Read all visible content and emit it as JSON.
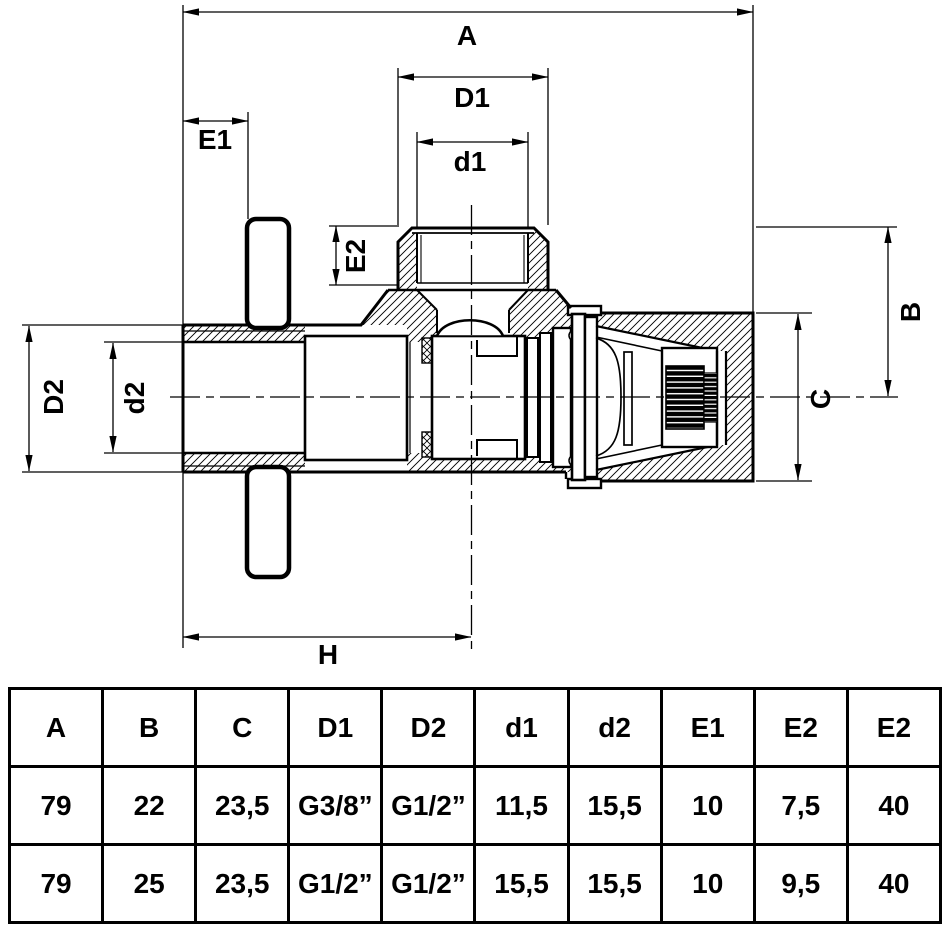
{
  "drawing": {
    "labels": {
      "a": "A",
      "d1_outer": "D1",
      "d1_inner": "d1",
      "e1": "E1",
      "e2": "E2",
      "b": "B",
      "c": "C",
      "d2_outer": "D2",
      "d2_inner": "d2",
      "h": "H"
    }
  },
  "table": {
    "headers": [
      "A",
      "B",
      "C",
      "D1",
      "D2",
      "d1",
      "d2",
      "E1",
      "E2",
      "E2"
    ],
    "rows": [
      [
        "79",
        "22",
        "23,5",
        "G3/8”",
        "G1/2”",
        "11,5",
        "15,5",
        "10",
        "7,5",
        "40"
      ],
      [
        "79",
        "25",
        "23,5",
        "G1/2”",
        "G1/2”",
        "15,5",
        "15,5",
        "10",
        "9,5",
        "40"
      ]
    ]
  },
  "colors": {
    "line": "#000000",
    "background": "#ffffff"
  }
}
